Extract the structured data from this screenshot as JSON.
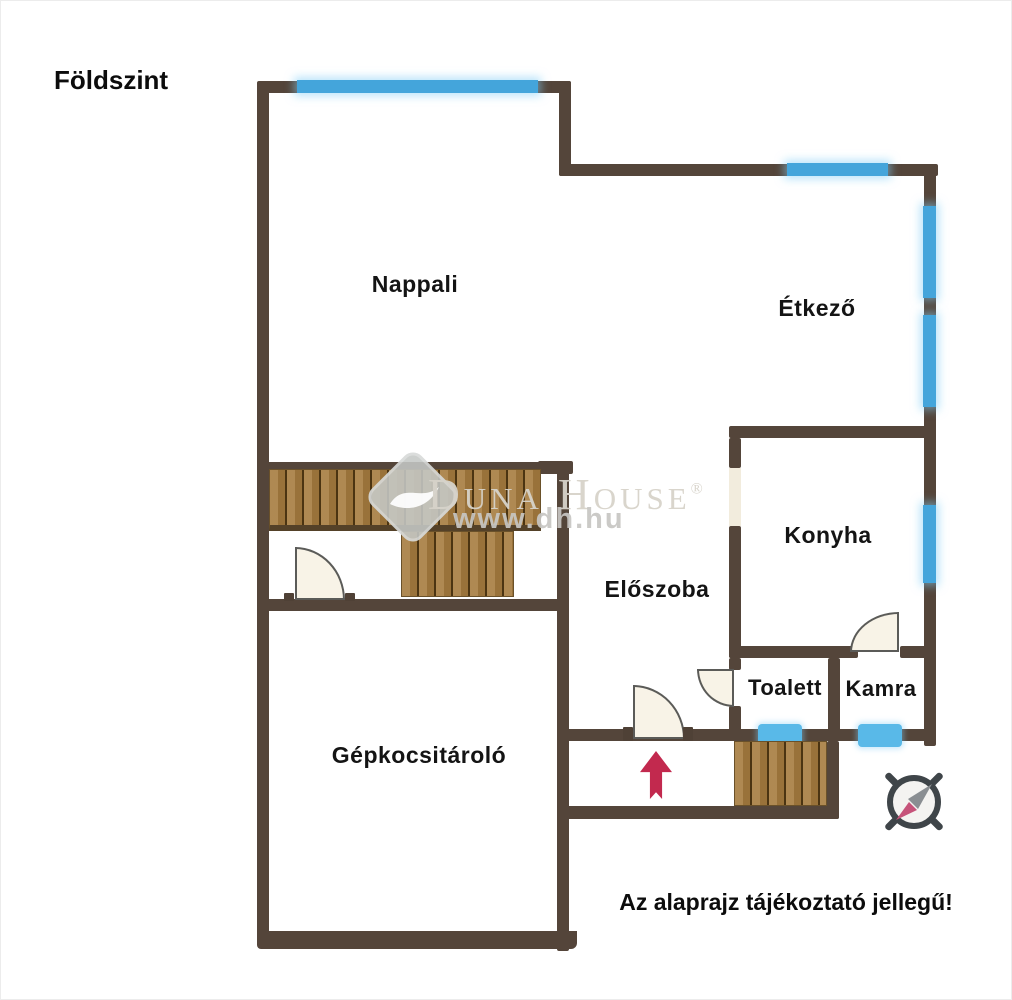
{
  "title": "Földszint",
  "disclaimer": "Az alaprajz tájékoztató jellegű!",
  "rooms": {
    "nappali": "Nappali",
    "etkezo": "Étkező",
    "konyha": "Konyha",
    "eloszoba": "Előszoba",
    "toalett": "Toalett",
    "kamra": "Kamra",
    "garage": "Gépkocsitároló"
  },
  "watermark": {
    "brand": "Duna House",
    "registered": "®",
    "url": "www.dh.hu"
  },
  "colors": {
    "wall": "#54453A",
    "window": "#44A5DB",
    "window_small": "#59B9E8",
    "stairs_wood": "#A67C3F",
    "door_fill": "#F8F3E7",
    "entrance_arrow": "#C2294E",
    "compass_ring": "#3F4549",
    "compass_needle_red": "#C6537A",
    "watermark_gray": "#D7D3CA",
    "text": "#141414"
  }
}
